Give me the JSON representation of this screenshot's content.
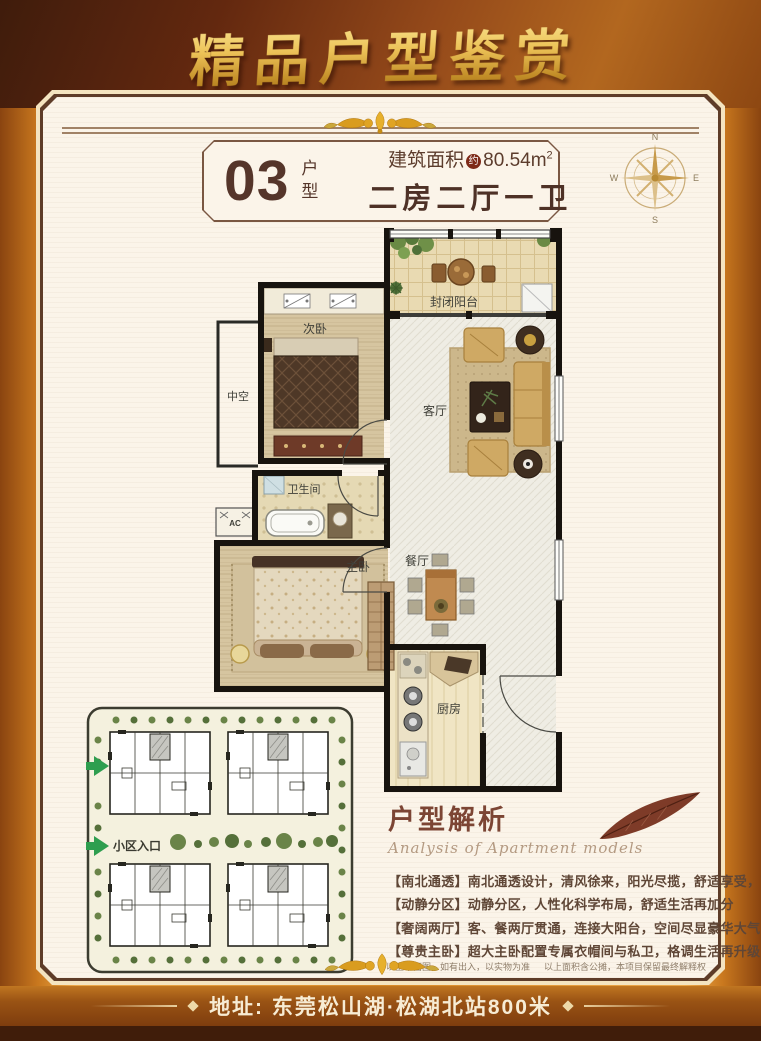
{
  "poster": {
    "title": "精品户型鉴赏",
    "theme": {
      "frame_gold": "#d88a28",
      "title_gold": "#ecc257",
      "panel_cream": "#fbf4e9",
      "text_brown": "#55352a",
      "accent_green": "#2e9e4f"
    },
    "unit": {
      "number": "03",
      "number_suffix": "户型",
      "area_label": "建筑面积",
      "area_approx_badge": "约",
      "area_value": "80.54m",
      "area_superscript": "2",
      "layout_text": "二房二厅一卫"
    },
    "compass": {
      "north": "N",
      "south": "S",
      "east": "E",
      "west": "W"
    },
    "floorplan": {
      "rooms": {
        "balcony": "封闭阳台",
        "second_bedroom": "次卧",
        "living_room": "客厅",
        "void": "中空",
        "bathroom": "卫生间",
        "ac": "AC",
        "master_bedroom": "主卧",
        "dining_room": "餐厅",
        "kitchen": "厨房"
      }
    },
    "siteplan": {
      "entrance_label": "小区入口"
    },
    "analysis": {
      "title": "户型解析",
      "subtitle": "Analysis of Apartment models",
      "points": [
        "【南北通透】南北通透设计，清风徐来，阳光尽揽，舒适享受，高人一等",
        "【动静分区】动静分区，人性化科学布局，舒适生活再加分",
        "【奢阔两厅】客、餐两厅贯通，连接大阳台，空间尽显豪华大气",
        "【尊贵主卧】超大主卧配置专属衣帽间与私卫，格调生活再升级"
      ]
    },
    "disclaimer": {
      "part1": "以上平面图，如有出入，以实物为准",
      "part2": "以上面积含公摊，本项目保留最终解释权"
    },
    "footer": {
      "address": "地址: 东莞松山湖·松湖北站800米"
    }
  }
}
